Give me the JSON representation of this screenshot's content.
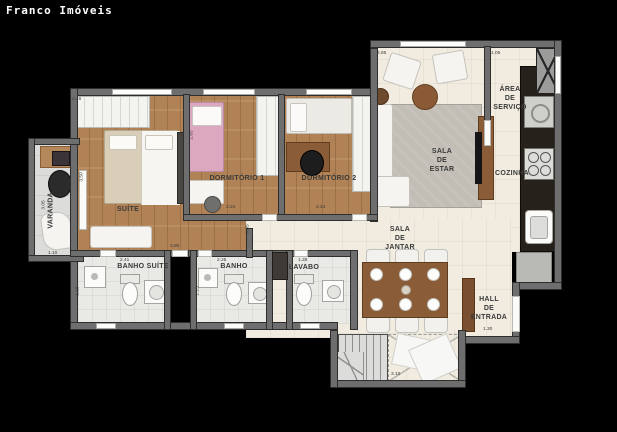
{
  "brand": "Franco Imóveis",
  "floor_plan": {
    "rooms": {
      "varanda": "VARANDA",
      "suite": "SUÍTE",
      "dormitorio1": "DORMITÓRIO 1",
      "dormitorio2": "DORMITÓRIO 2",
      "banho_suite": "BANHO SUÍTE",
      "banho": "BANHO",
      "lavabo": "LAVABO",
      "sala_estar": "SALA\nDE\nESTAR",
      "area_servico": "ÁREA\nDE\nSERVIÇO",
      "cozinha": "COZINHA",
      "sala_jantar": "SALA\nDE\nJANTAR",
      "hall": "HALL\nDE\nENTRADA"
    },
    "dims": {
      "suite_top": "2.46",
      "suite_left": "3.50",
      "suite_bottom": "3.80",
      "dorm1_left": "2.65",
      "dorm1_bottom": "2.24",
      "dorm2_bottom": "2.24",
      "banho_suite_top": "2.41",
      "banho_suite_left": "1.15",
      "banho_top": "2.26",
      "banho_left": "1.15",
      "lavabo_top": "1.28",
      "corridor": "0.85",
      "varanda_bottom": "1.10",
      "varanda_left": "3.05",
      "sala_estar_top": "2.85",
      "servico_top": "1.05",
      "hall_width": "1.30",
      "stairs_width": "3.10"
    }
  },
  "colors": {
    "background": "#000000",
    "floor_tile": "#f1ecdf",
    "floor_wood": "#b08255",
    "floor_varanda": "#dcdcda",
    "floor_bath": "#e9e9e5",
    "wall": "#6e6e6e",
    "wall_edge": "#2e2e2e",
    "counter_dark": "#26211b",
    "wood_furniture": "#8a5c38",
    "rug": "#c2beb6",
    "accent_pink": "#dca8c0",
    "label_text": "#3a3a3a",
    "brand_text": "#ffffff"
  }
}
